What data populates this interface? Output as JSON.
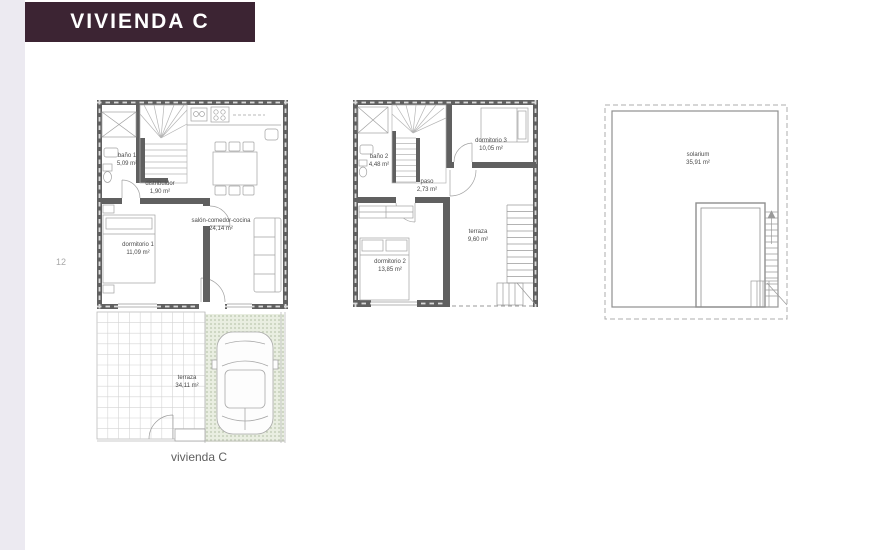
{
  "page": {
    "title": "VIVIENDA C",
    "page_number": "12",
    "caption": "vivienda C"
  },
  "colors": {
    "header_bg": "#3c2433",
    "header_text": "#ffffff",
    "sidebar_bg": "#eceaf1",
    "wall": "#606060",
    "wall_dash": "#dadada",
    "furniture_line": "#a2a2a2",
    "tile_line": "#d4d4d4",
    "parking_bg": "#e9eee1",
    "parking_dot": "#b7c3a9",
    "label_text": "#4a4a4a"
  },
  "plans": [
    {
      "rooms": [
        {
          "label": "baño 1",
          "area": "5,09 m²"
        },
        {
          "label": "distribuidor",
          "area": "1,90 m²"
        },
        {
          "label": "salón-comedor-cocina",
          "area": "24,14 m²"
        },
        {
          "label": "dormitorio 1",
          "area": "11,09 m²"
        },
        {
          "label": "terraza",
          "area": "34,11 m²"
        }
      ]
    },
    {
      "rooms": [
        {
          "label": "baño 2",
          "area": "4,48 m²"
        },
        {
          "label": "paso",
          "area": "2,73 m²"
        },
        {
          "label": "dormitorio 3",
          "area": "10,05 m²"
        },
        {
          "label": "dormitorio 2",
          "area": "13,85 m²"
        },
        {
          "label": "terraza",
          "area": "9,60 m²"
        }
      ]
    },
    {
      "rooms": [
        {
          "label": "solarium",
          "area": "35,91 m²"
        }
      ]
    }
  ]
}
